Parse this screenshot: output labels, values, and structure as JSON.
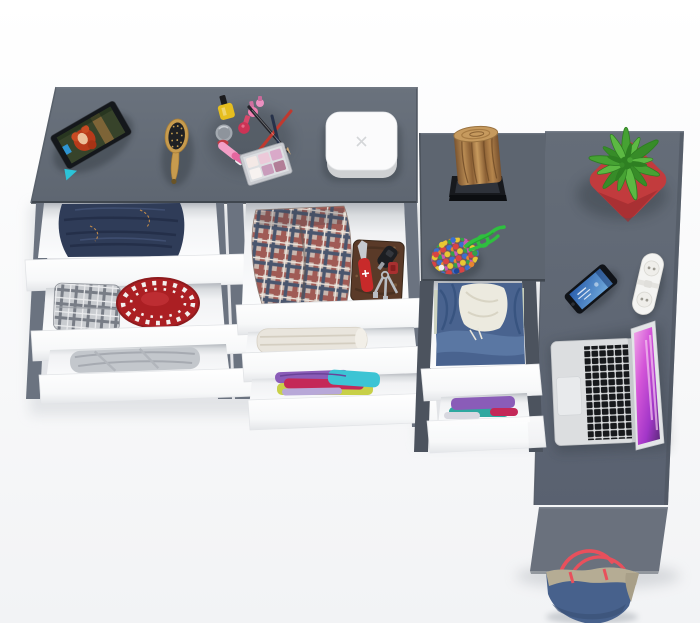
{
  "scene": {
    "description": "Top view 3D render of a gray L-shaped dresser and corner desk with open white drawers full of clothes and accessories"
  },
  "colors": {
    "surface": "#646c77",
    "surfaceDark": "#5f6772",
    "edge": "#454c55",
    "rail": "#6b7380",
    "railDark": "#4c535e",
    "front": "#fdfdfe",
    "hatRed": "#ab1f23",
    "denim": "#2f3c58",
    "wood": "#b5854c",
    "standBlack": "#17191d",
    "potRed": "#c23b3d",
    "leafGreen": "#46a233",
    "cordGreen": "#2fbf3f",
    "hoodieBlue": "#49638f",
    "fleece": "#eceadf",
    "bagBlue": "#47618c",
    "bagBeige": "#b5ac94",
    "strapRed": "#e8505c",
    "tabletBlack": "#14171b",
    "standCyan": "#2cc4d8",
    "boxWhite": "#fbfbfc",
    "brushTan": "#c79b4e",
    "knifeRed": "#c82a2a",
    "walletBrown": "#5a3a28",
    "towel": "#e9e5dd",
    "purple": "#8a5cb8",
    "teal": "#3cc4d4",
    "crimson": "#c42858",
    "stripWhite": "#f4f4f2",
    "laptopSilver": "#dcdee0",
    "screenPink": "#d455d8"
  },
  "furniture": {
    "left_dresser": {
      "label": "Gray dresser top with six open drawers"
    },
    "wardrobe": {
      "label": "Gray wardrobe module with two open drawers"
    },
    "desk": {
      "label": "Gray corner desk surface"
    },
    "desk_leg": {
      "label": "Desk side panel"
    },
    "drawer_fronts": {
      "label": "White drawer front"
    }
  },
  "items": {
    "tablet": {
      "label": "Tablet on stand showing cartoon photo"
    },
    "hairbrush": {
      "label": "Wooden hairbrush"
    },
    "cosmetics": {
      "label": "Nail polishes, lip gloss and makeup pencils"
    },
    "palette": {
      "label": "Eyeshadow palette"
    },
    "jewelry_box": {
      "label": "White rounded jewelry box"
    },
    "jeans": {
      "label": "Folded jeans in drawer"
    },
    "plaid_shirt": {
      "label": "Folded gray plaid shirt"
    },
    "red_hat": {
      "label": "Red hat with white ornament"
    },
    "gray_clothes": {
      "label": "Folded gray garment"
    },
    "plaid_shorts": {
      "label": "Folded red plaid shorts"
    },
    "wallet": {
      "label": "Brown wallet with car key"
    },
    "pocket_knife": {
      "label": "Red pocket knife"
    },
    "keys": {
      "label": "Key ring with keys and red fob"
    },
    "towel": {
      "label": "Folded beige towel"
    },
    "colorful_clothes": {
      "label": "Folded purple, teal and pink shirts"
    },
    "log": {
      "label": "Decorative wooden log on black stand"
    },
    "plant": {
      "label": "Green plant in red pot"
    },
    "bead_pouch": {
      "label": "Multicolor bead pouch with green cord"
    },
    "phone": {
      "label": "Smartphone with blue screen"
    },
    "power_strip": {
      "label": "White power strip"
    },
    "laptop": {
      "label": "Open laptop with pink wallpaper"
    },
    "hoodie": {
      "label": "Blue hoodie in drawer"
    },
    "purple_clothes": {
      "label": "Folded purple and teal clothes"
    },
    "tote_bag": {
      "label": "Blue and beige tote bag with red straps"
    }
  }
}
